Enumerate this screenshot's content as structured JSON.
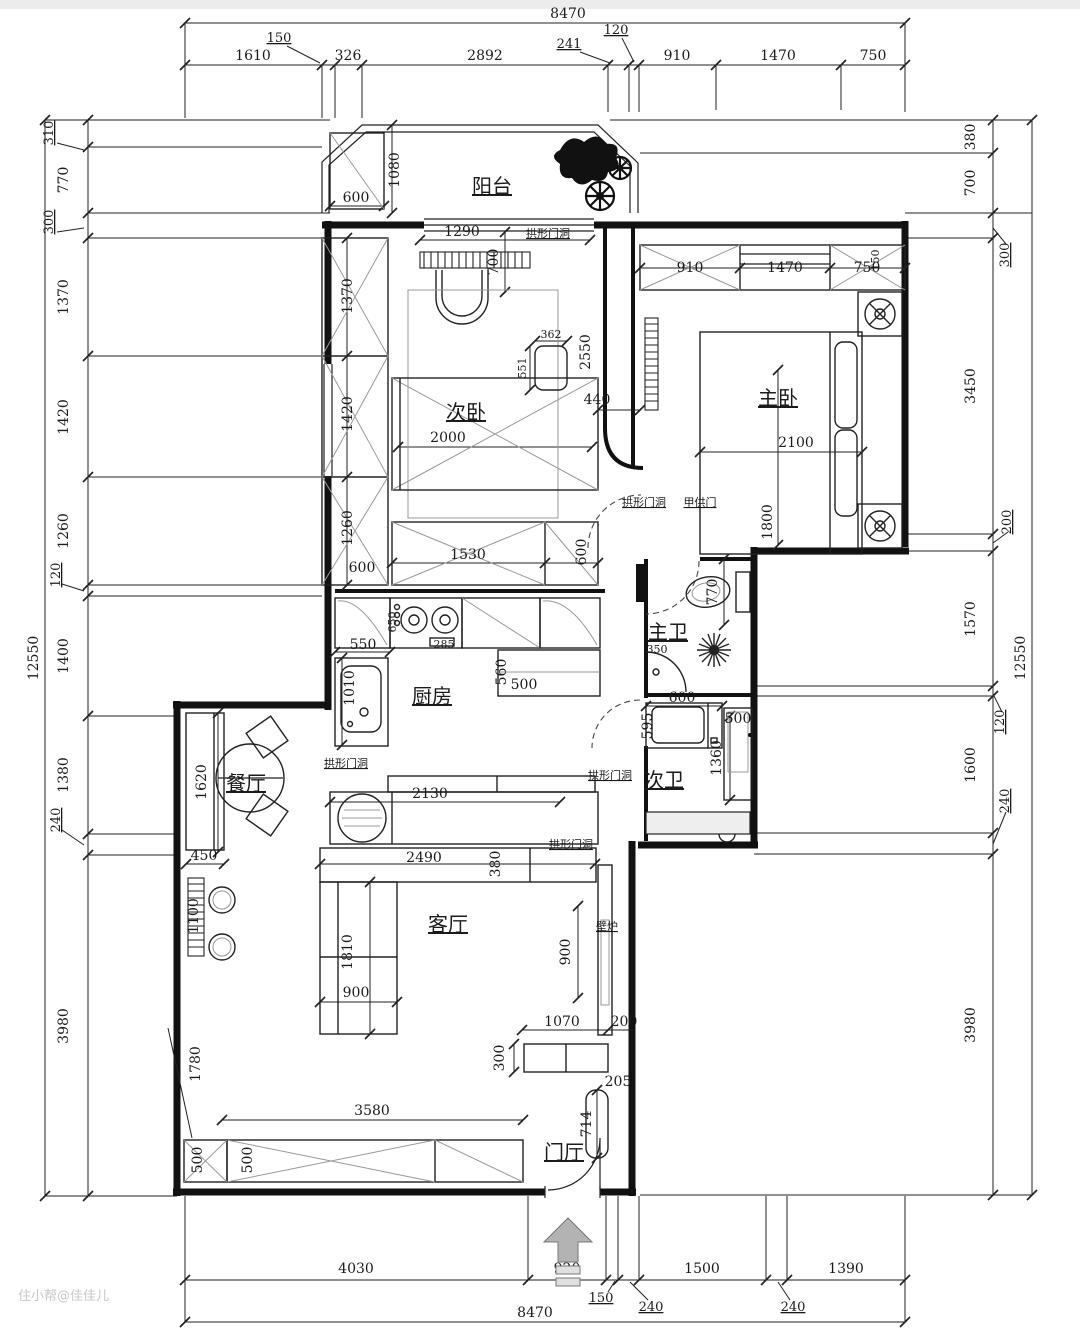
{
  "watermark": "住小帮@佳佳儿",
  "dimensions": {
    "top": {
      "total": "8470",
      "segments": [
        "1610",
        "150",
        "326",
        "2892",
        "241",
        "120",
        "910",
        "1470",
        "750"
      ]
    },
    "left": {
      "total": "12550",
      "segments": [
        "310",
        "770",
        "300",
        "1370",
        "1420",
        "1260",
        "120",
        "1400",
        "1380",
        "240",
        "3980"
      ]
    },
    "right": {
      "total": "12550",
      "segments": [
        "380",
        "700",
        "300",
        "3450",
        "200",
        "1570",
        "120",
        "1600",
        "240",
        "3980"
      ]
    },
    "bottom": {
      "total": "8470",
      "segments": [
        "4030",
        "920",
        "150",
        "240",
        "1500",
        "240",
        "1390"
      ]
    }
  },
  "annotations": {
    "arch_opening": "拱形门洞",
    "owner_door": "甲供门",
    "fireplace": "壁炉"
  },
  "rooms": {
    "balcony": {
      "label": "阳台",
      "dims": [
        "600",
        "1080",
        "1290",
        "700"
      ]
    },
    "second_bedroom": {
      "label": "次卧",
      "dims": [
        "1370",
        "1420",
        "1260",
        "600",
        "2000",
        "1530",
        "600",
        "362",
        "551",
        "2550",
        "440"
      ]
    },
    "master_bedroom": {
      "label": "主卧",
      "dims": [
        "910",
        "1470",
        "750",
        "150",
        "2100",
        "1800"
      ]
    },
    "kitchen": {
      "label": "厨房",
      "dims": [
        "550",
        "1010",
        "650",
        "285",
        "560",
        "500",
        "2130"
      ]
    },
    "master_bath": {
      "label": "主卫",
      "dims": [
        "770",
        "350"
      ]
    },
    "second_bath": {
      "label": "次卫",
      "dims": [
        "600",
        "595",
        "500",
        "1360"
      ]
    },
    "dining": {
      "label": "餐厅",
      "dims": [
        "1620",
        "450",
        "1100"
      ]
    },
    "living": {
      "label": "客厅",
      "dims": [
        "2490",
        "380",
        "1810",
        "900",
        "900",
        "1070",
        "200",
        "300",
        "205",
        "714",
        "3580",
        "500",
        "500",
        "1780"
      ]
    },
    "entry": {
      "label": "门厅"
    }
  }
}
